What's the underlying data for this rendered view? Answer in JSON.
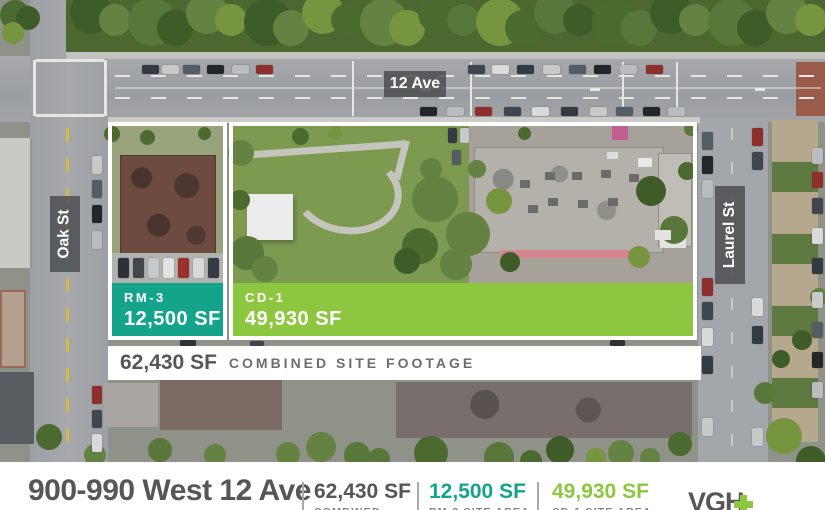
{
  "map": {
    "street_labels": {
      "ave12": "12 Ave",
      "oak": "Oak St",
      "laurel": "Laurel St"
    },
    "parcels": {
      "rm3": {
        "zone": "RM-3",
        "area": "12,500 SF"
      },
      "cd1": {
        "zone": "CD-1",
        "area": "49,930 SF"
      }
    },
    "combined": {
      "value": "62,430 SF",
      "label": "COMBINED SITE FOOTAGE"
    }
  },
  "footer": {
    "title": "900-990 West 12 Ave",
    "stats": [
      {
        "value": "62,430 SF",
        "label": "COMBINED"
      },
      {
        "value": "12,500 SF",
        "label": "RM-3 SITE AREA"
      },
      {
        "value": "49,930 SF",
        "label": "CD-1 SITE AREA"
      }
    ],
    "logo": {
      "text": "VGH",
      "plus_symbol": "+"
    }
  },
  "colors": {
    "teal": "#14a38b",
    "green": "#8dc63f",
    "dark_gray": "#55565a",
    "label_gray": "#808285"
  }
}
